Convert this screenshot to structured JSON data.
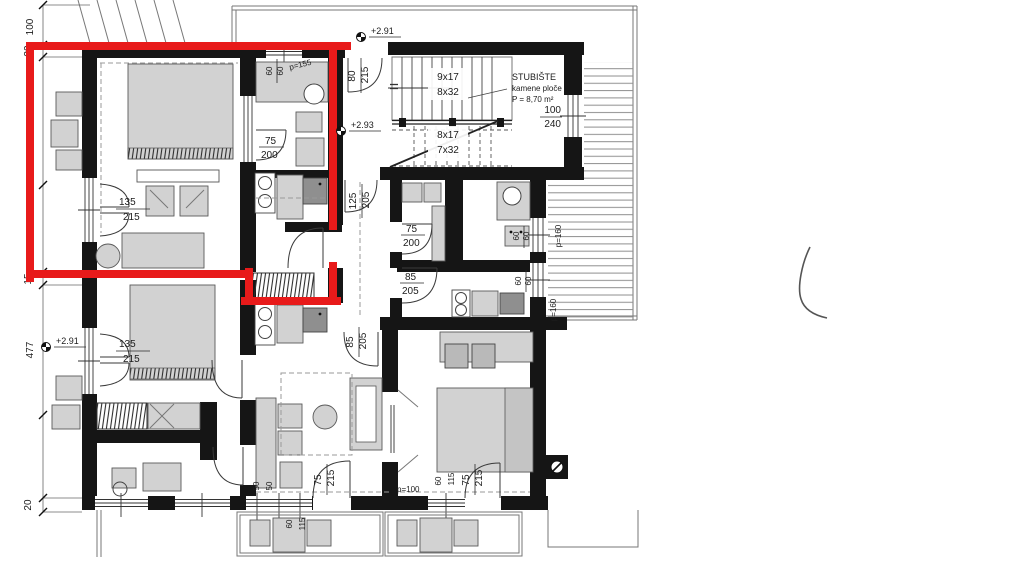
{
  "colors": {
    "highlight": "#e81a1a",
    "wall": "#151515",
    "furniture": "#d2d2d2"
  },
  "dimensions": {
    "top": "100",
    "wall_top": "20",
    "upper": "456",
    "wall_mid": "15",
    "lower": "477",
    "wall_bottom": "20"
  },
  "elevations": {
    "upper": "+2.91",
    "landing": "+2.93",
    "lower_left": "+2.91"
  },
  "stairwell": {
    "name": "STUBIŠTE",
    "material": "kamene ploče",
    "area": "P = 8,70 m²",
    "flight_up_risers": "9x17",
    "flight_up_treads": "8x32",
    "flight_down_risers": "8x17",
    "flight_down_treads": "7x32",
    "window_width": "100",
    "window_height": "240"
  },
  "doors": {
    "apartment_entry": {
      "w": "80",
      "h": "215"
    },
    "bath_left": {
      "w": "75",
      "h": "200"
    },
    "balcony_upper_left": {
      "w": "135",
      "h": "215"
    },
    "hall_top": {
      "w": "125",
      "h": "205"
    },
    "bath_right": {
      "w": "75",
      "h": "200"
    },
    "room_right": {
      "w": "85",
      "h": "205"
    },
    "living_mid": {
      "w": "85",
      "h": "205"
    },
    "balcony_lower_left": {
      "w": "135",
      "h": "215"
    },
    "terrace_center": {
      "w": "75",
      "h": "215"
    },
    "terrace_right": {
      "w": "75",
      "h": "215"
    }
  },
  "windows": {
    "kitchen_top": {
      "a": "60",
      "b": "60",
      "parapet": "p=155"
    },
    "right_upper": {
      "a": "60",
      "b": "60",
      "parapet": "p=160"
    },
    "right_lower": {
      "a": "60",
      "b": "60",
      "parapet": "p=160"
    },
    "bottom_pair": {
      "a": "50",
      "b": "50"
    },
    "bottom_center": {
      "a": "60",
      "b": "115"
    },
    "bottom_right": {
      "a": "60",
      "b": "115",
      "parapet": "p=100"
    }
  }
}
